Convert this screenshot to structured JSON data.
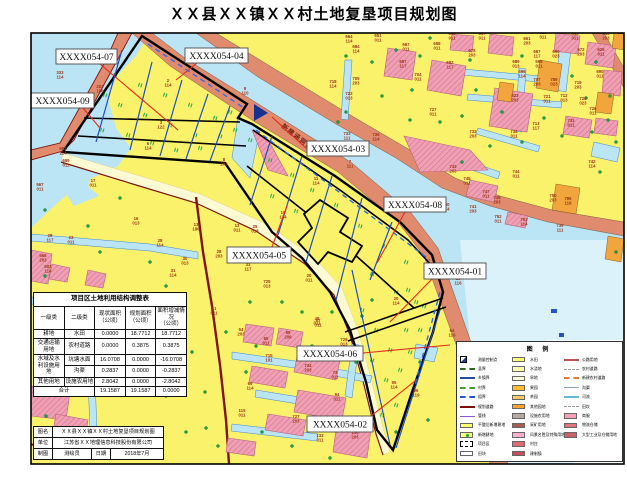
{
  "title": "ＸＸ县ＸＸ镇ＸＸ村土地复垦项目规划图",
  "annotation": {
    "text": "新建涵洞1",
    "x": 281,
    "y": 127,
    "rot": 38
  },
  "callouts": [
    {
      "id": "XXXX054-07",
      "x": 56,
      "y": 49,
      "w": 61,
      "h": 15,
      "lead": [
        100,
        64,
        178,
        130
      ]
    },
    {
      "id": "XXXX054-04",
      "x": 185,
      "y": 48,
      "w": 63,
      "h": 15,
      "lead": [
        197,
        63,
        176,
        80
      ]
    },
    {
      "id": "XXXX054-09",
      "x": 31,
      "y": 93,
      "w": 63,
      "h": 15,
      "lead": [
        83,
        108,
        100,
        128
      ]
    },
    {
      "id": "XXXX054-03",
      "x": 307,
      "y": 141,
      "w": 62,
      "h": 15,
      "lead": [
        307,
        149,
        272,
        117
      ]
    },
    {
      "id": "XXXX054-08",
      "x": 384,
      "y": 197,
      "w": 62,
      "h": 15,
      "lead": [
        405,
        212,
        377,
        263
      ]
    },
    {
      "id": "XXXX054-05",
      "x": 227,
      "y": 247,
      "w": 64,
      "h": 16,
      "lead": [
        272,
        247,
        287,
        206
      ]
    },
    {
      "id": "XXXX054-01",
      "x": 424,
      "y": 263,
      "w": 62,
      "h": 16,
      "lead": [
        432,
        279,
        390,
        322
      ]
    },
    {
      "id": "XXXX054-06",
      "x": 297,
      "y": 346,
      "w": 66,
      "h": 15,
      "lead": [
        363,
        353,
        450,
        345
      ]
    },
    {
      "id": "XXXX054-02",
      "x": 307,
      "y": 416,
      "w": 66,
      "h": 16,
      "lead": [
        371,
        416,
        415,
        381
      ]
    }
  ],
  "parcel_labels": [
    {
      "x": 60,
      "y": 74,
      "a": "333",
      "b": "114"
    },
    {
      "x": 100,
      "y": 88,
      "a": "203",
      "b": "196"
    },
    {
      "x": 63,
      "y": 150,
      "a": "681",
      "b": "114"
    },
    {
      "x": 66,
      "y": 162,
      "a": "699",
      "b": "011"
    },
    {
      "x": 40,
      "y": 186,
      "a": "567",
      "b": "011"
    },
    {
      "x": 93,
      "y": 182,
      "a": "17",
      "b": "011"
    },
    {
      "x": 136,
      "y": 220,
      "a": "16",
      "b": "013"
    },
    {
      "x": 71,
      "y": 239,
      "a": "23",
      "b": "011"
    },
    {
      "x": 160,
      "y": 242,
      "a": "28",
      "b": "114"
    },
    {
      "x": 50,
      "y": 237,
      "a": "28",
      "b": "117"
    },
    {
      "x": 185,
      "y": 260,
      "a": "30",
      "b": "013"
    },
    {
      "x": 173,
      "y": 272,
      "a": "31",
      "b": "114"
    },
    {
      "x": 267,
      "y": 283,
      "a": "725",
      "b": "013"
    },
    {
      "x": 43,
      "y": 257,
      "a": "665",
      "b": "203"
    },
    {
      "x": 48,
      "y": 268,
      "a": "602",
      "b": "114"
    },
    {
      "x": 168,
      "y": 82,
      "a": "2",
      "b": "114"
    },
    {
      "x": 161,
      "y": 124,
      "a": "3",
      "b": "122"
    },
    {
      "x": 148,
      "y": 145,
      "a": "6",
      "b": "114"
    },
    {
      "x": 245,
      "y": 90,
      "a": "9",
      "b": "110"
    },
    {
      "x": 224,
      "y": 161,
      "a": "8",
      "b": "203"
    },
    {
      "x": 316,
      "y": 180,
      "a": "11",
      "b": "114"
    },
    {
      "x": 350,
      "y": 163,
      "a": "7",
      "b": "111"
    },
    {
      "x": 283,
      "y": 214,
      "a": "19",
      "b": "134"
    },
    {
      "x": 255,
      "y": 228,
      "a": "25",
      "b": "013"
    },
    {
      "x": 237,
      "y": 227,
      "a": "13",
      "b": "011"
    },
    {
      "x": 219,
      "y": 253,
      "a": "28",
      "b": "203"
    },
    {
      "x": 248,
      "y": 266,
      "a": "33",
      "b": "117"
    },
    {
      "x": 309,
      "y": 277,
      "a": "20",
      "b": "011"
    },
    {
      "x": 396,
      "y": 300,
      "a": "20",
      "b": "114"
    },
    {
      "x": 196,
      "y": 226,
      "a": "13",
      "b": "186"
    },
    {
      "x": 214,
      "y": 310,
      "a": "41",
      "b": "011"
    },
    {
      "x": 317,
      "y": 320,
      "a": "49",
      "b": "011"
    },
    {
      "x": 394,
      "y": 384,
      "a": "95",
      "b": "114"
    },
    {
      "x": 416,
      "y": 392,
      "a": "96",
      "b": "119"
    },
    {
      "x": 458,
      "y": 280,
      "a": "15",
      "b": "116"
    },
    {
      "x": 452,
      "y": 332,
      "a": "64",
      "b": "116"
    },
    {
      "x": 241,
      "y": 331,
      "a": "54",
      "b": "203"
    },
    {
      "x": 266,
      "y": 340,
      "a": "60",
      "b": "011"
    },
    {
      "x": 288,
      "y": 334,
      "a": "89",
      "b": "209"
    },
    {
      "x": 318,
      "y": 322,
      "a": "87",
      "b": "011"
    },
    {
      "x": 344,
      "y": 341,
      "a": "728",
      "b": "013"
    },
    {
      "x": 269,
      "y": 357,
      "a": "715",
      "b": "101"
    },
    {
      "x": 308,
      "y": 367,
      "a": "734",
      "b": "203"
    },
    {
      "x": 335,
      "y": 374,
      "a": "73",
      "b": "011"
    },
    {
      "x": 250,
      "y": 385,
      "a": "69",
      "b": "114"
    },
    {
      "x": 337,
      "y": 396,
      "a": "94",
      "b": "011"
    },
    {
      "x": 296,
      "y": 418,
      "a": "727",
      "b": "203"
    },
    {
      "x": 320,
      "y": 437,
      "a": "133",
      "b": "011"
    },
    {
      "x": 355,
      "y": 434,
      "a": "130",
      "b": "203"
    },
    {
      "x": 242,
      "y": 412,
      "a": "115",
      "b": "011"
    },
    {
      "x": 378,
      "y": 37,
      "a": "651",
      "b": "011"
    },
    {
      "x": 406,
      "y": 46,
      "a": "667",
      "b": "011"
    },
    {
      "x": 437,
      "y": 45,
      "a": "658",
      "b": "011"
    },
    {
      "x": 452,
      "y": 35,
      "a": "645",
      "b": "011"
    },
    {
      "x": 482,
      "y": 35,
      "a": "647",
      "b": "011"
    },
    {
      "x": 527,
      "y": 40,
      "a": "661",
      "b": "203"
    },
    {
      "x": 543,
      "y": 34,
      "a": "628",
      "b": "011"
    },
    {
      "x": 575,
      "y": 35,
      "a": "643",
      "b": "011"
    },
    {
      "x": 606,
      "y": 35,
      "a": "653",
      "b": "203"
    },
    {
      "x": 472,
      "y": 52,
      "a": "679",
      "b": "203"
    },
    {
      "x": 450,
      "y": 64,
      "a": "682",
      "b": "117"
    },
    {
      "x": 537,
      "y": 53,
      "a": "667",
      "b": "117"
    },
    {
      "x": 556,
      "y": 53,
      "a": "690",
      "b": "023"
    },
    {
      "x": 581,
      "y": 51,
      "a": "672",
      "b": "203"
    },
    {
      "x": 601,
      "y": 51,
      "a": "626",
      "b": "011"
    },
    {
      "x": 516,
      "y": 63,
      "a": "689",
      "b": "013"
    },
    {
      "x": 522,
      "y": 73,
      "a": "696",
      "b": "114"
    },
    {
      "x": 539,
      "y": 63,
      "a": "698",
      "b": "011"
    },
    {
      "x": 537,
      "y": 81,
      "a": "707",
      "b": "203"
    },
    {
      "x": 554,
      "y": 81,
      "a": "789",
      "b": "023"
    },
    {
      "x": 600,
      "y": 73,
      "a": "690",
      "b": "011"
    },
    {
      "x": 578,
      "y": 84,
      "a": "719",
      "b": "203"
    },
    {
      "x": 418,
      "y": 76,
      "a": "704",
      "b": "011"
    },
    {
      "x": 433,
      "y": 111,
      "a": "727",
      "b": "011"
    },
    {
      "x": 473,
      "y": 133,
      "a": "732",
      "b": "203"
    },
    {
      "x": 515,
      "y": 97,
      "a": "823",
      "b": "203"
    },
    {
      "x": 547,
      "y": 98,
      "a": "721",
      "b": "011"
    },
    {
      "x": 564,
      "y": 97,
      "a": "712",
      "b": "013"
    },
    {
      "x": 583,
      "y": 100,
      "a": "720",
      "b": "023"
    },
    {
      "x": 571,
      "y": 122,
      "a": "731",
      "b": "011"
    },
    {
      "x": 593,
      "y": 110,
      "a": "726",
      "b": "011"
    },
    {
      "x": 536,
      "y": 125,
      "a": "713",
      "b": "117"
    },
    {
      "x": 514,
      "y": 133,
      "a": "734",
      "b": "011"
    },
    {
      "x": 347,
      "y": 135,
      "a": "733",
      "b": "111"
    },
    {
      "x": 376,
      "y": 136,
      "a": "736",
      "b": "114"
    },
    {
      "x": 333,
      "y": 83,
      "a": "718",
      "b": "114"
    },
    {
      "x": 356,
      "y": 80,
      "a": "705",
      "b": "203"
    },
    {
      "x": 349,
      "y": 95,
      "a": "722",
      "b": "013"
    },
    {
      "x": 356,
      "y": 48,
      "a": "684",
      "b": "114"
    },
    {
      "x": 349,
      "y": 38,
      "a": "664",
      "b": "114"
    },
    {
      "x": 403,
      "y": 63,
      "a": "687",
      "b": "117"
    },
    {
      "x": 592,
      "y": 163,
      "a": "742",
      "b": "114"
    },
    {
      "x": 453,
      "y": 168,
      "a": "743",
      "b": "203"
    },
    {
      "x": 467,
      "y": 180,
      "a": "745",
      "b": "011"
    },
    {
      "x": 516,
      "y": 173,
      "a": "744",
      "b": "011"
    },
    {
      "x": 486,
      "y": 193,
      "a": "747",
      "b": "011"
    },
    {
      "x": 497,
      "y": 199,
      "a": "748",
      "b": "203"
    },
    {
      "x": 446,
      "y": 206,
      "a": "740",
      "b": "114"
    },
    {
      "x": 473,
      "y": 208,
      "a": "741",
      "b": "203"
    },
    {
      "x": 498,
      "y": 218,
      "a": "752",
      "b": "011"
    },
    {
      "x": 524,
      "y": 221,
      "a": "753",
      "b": "114"
    },
    {
      "x": 560,
      "y": 227,
      "a": "739",
      "b": "111"
    },
    {
      "x": 553,
      "y": 197,
      "a": "750",
      "b": "203"
    },
    {
      "x": 568,
      "y": 200,
      "a": "786",
      "b": "118"
    }
  ],
  "table": {
    "title": "项目区土地利用结构调整表",
    "headers": {
      "h1": "一级类",
      "h2": "二级类",
      "h3": "现状面积\n（公顷）",
      "h4": "规划面积\n（公顷）",
      "h5": "面积增减情况\n（公顷）"
    },
    "rows": {
      "r1": {
        "c1": "耕地",
        "c2": "水田",
        "cur": "0.0000",
        "plan": "18.7712",
        "delta": "18.7712"
      },
      "r2": {
        "c1": "交通运输\n用地",
        "c2": "农村道路",
        "cur": "0.0000",
        "plan": "0.3875",
        "delta": "0.3875"
      },
      "r3": {
        "c1": "水域及水\n利设施用\n地",
        "c2": "坑塘水面",
        "cur": "16.0708",
        "plan": "0.0000",
        "delta": "-16.0708"
      },
      "r4": {
        "c2": "沟渠",
        "cur": "0.2837",
        "plan": "0.0000",
        "delta": "-0.2837"
      },
      "r5": {
        "c1": "其他用地",
        "c2": "设施农用地",
        "cur": "2.8042",
        "plan": "0.0000",
        "delta": "-2.8042"
      },
      "r6": {
        "c1": "合计",
        "cur": "19.1587",
        "plan": "19.1587",
        "delta": "0.0000"
      }
    }
  },
  "titleblock": {
    "name_label": "图名",
    "name_value": "ＸＸ县ＸＸ镇ＸＸ村土地复垦项目规划图",
    "unit_label": "单位",
    "unit_value": "江苏省ＸＸ地理信息科技股份有限公司",
    "draw_label": "制图",
    "draw_value": "测绘员",
    "date_label": "日期",
    "date_value": "2018年7月"
  },
  "legend": {
    "title": "图 例",
    "col1": [
      {
        "sym": "cp",
        "label": "测量控制点"
      },
      {
        "sym": "line",
        "color": "#2E6B1E",
        "dash": true,
        "w": 2,
        "label": "县界"
      },
      {
        "sym": "line",
        "color": "#1F4E9C",
        "dash": false,
        "w": 2,
        "label": "乡镇界"
      },
      {
        "sym": "line",
        "color": "#3FA02E",
        "dash": true,
        "w": 2,
        "label": "村界"
      },
      {
        "sym": "line",
        "color": "#2255CC",
        "dash": true,
        "w": 2,
        "label": "组界"
      },
      {
        "sym": "line",
        "color": "#7A1008",
        "dash": false,
        "w": 2,
        "label": "规划道路"
      },
      {
        "sym": "line",
        "color": "#8C5BD9",
        "dash": false,
        "w": 1.5,
        "label": "管线"
      },
      {
        "sym": "rect",
        "color": "#FFFF73",
        "label": "平整后新增耕地"
      },
      {
        "sym": "rect-dot",
        "color": "#FFFF73",
        "label": "新增耕地"
      },
      {
        "sym": "rect-dash",
        "color": "#FFFFFF",
        "label": "项目区"
      },
      {
        "sym": "rect",
        "color": "#FFFFFF",
        "label": "田块"
      }
    ],
    "col2": [
      {
        "sym": "rect",
        "color": "#FFFF73",
        "label": "水田"
      },
      {
        "sym": "rect",
        "color": "#FFFFB0",
        "label": "水浇地"
      },
      {
        "sym": "rect",
        "color": "#FFFFD9",
        "label": "旱地"
      },
      {
        "sym": "rect",
        "color": "#FFBE2E",
        "label": "果园"
      },
      {
        "sym": "rect",
        "color": "#FFC966",
        "label": "茶园"
      },
      {
        "sym": "rect",
        "color": "#FFA32B",
        "label": "其他园地"
      },
      {
        "sym": "rect",
        "color": "#B4AAA3",
        "label": "设施农用地"
      },
      {
        "sym": "rect",
        "color": "#A65E51",
        "label": "采矿用地"
      },
      {
        "sym": "rect",
        "color": "#FFAEC9",
        "label": "风景名胜及特殊用地"
      },
      {
        "sym": "rect",
        "color": "#E06A72",
        "label": "村庄"
      },
      {
        "sym": "rect",
        "color": "#C75059",
        "label": "建制镇"
      }
    ],
    "col3": [
      {
        "sym": "line",
        "color": "#C0504D",
        "dash": false,
        "w": 2,
        "label": "公路用地"
      },
      {
        "sym": "line",
        "color": "#999999",
        "dash": true,
        "w": 1,
        "label": "农村道路"
      },
      {
        "sym": "line",
        "color": "#E07B39",
        "dash": true,
        "w": 2,
        "label": "新建农村道路"
      },
      {
        "sym": "line",
        "color": "#88AAAA",
        "dash": false,
        "w": 1,
        "label": "沟渠"
      },
      {
        "sym": "line",
        "color": "#66B8D9",
        "dash": false,
        "w": 2,
        "label": "河流"
      },
      {
        "sym": "line",
        "color": "#999999",
        "dash": true,
        "w": 1,
        "label": "田坎"
      },
      {
        "sym": "rect",
        "color": "#F2A2B6",
        "label": "商服"
      },
      {
        "sym": "rect",
        "color": "#E2737B",
        "label": "物流仓储"
      },
      {
        "sym": "rect",
        "color": "#CC5F66",
        "label": "大型工业及仓储用地"
      }
    ]
  },
  "colors": {
    "field_yellow": "#FBF26B",
    "water": "#BBE4F5",
    "road_salmon": "#E08A6E",
    "settlement_pink": "#F0A0B4",
    "orange_parcel": "#F2A53C",
    "road_maroon": "#7E150F",
    "parcel_text": "#9C3318",
    "leader_red": "#E8281E",
    "project_boundary": "#000000",
    "strip_blue": "#1D4FC0"
  }
}
